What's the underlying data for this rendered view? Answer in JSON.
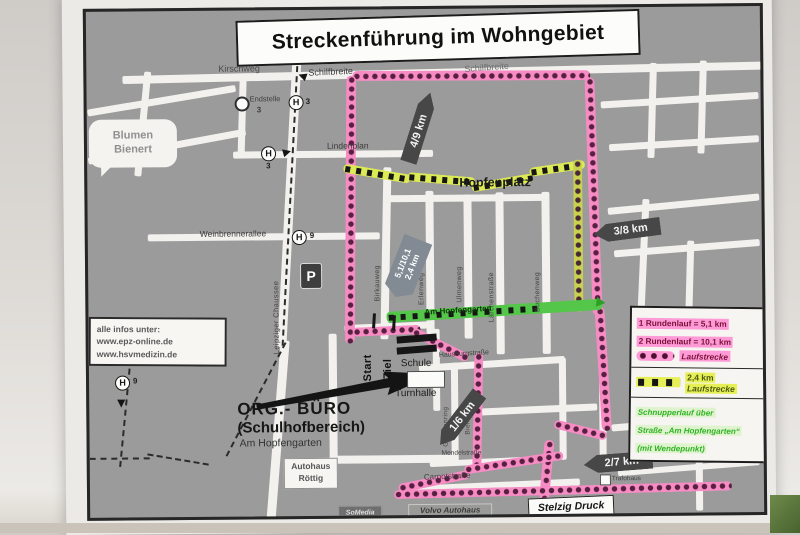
{
  "title": "Streckenführung im Wohngebiet",
  "streets": {
    "kirschweg": "Kirschweg",
    "schilfbreite_left": "Schilfbreite",
    "schilfbreite_right": "Schilfbreite",
    "lindenplan": "Lindenplan",
    "weinbrennerallee": "Weinbrennerallee",
    "leipziger_chaussee": "Leipziger Chaussee",
    "am_hopfengarten": "Am Hopfengarten",
    "carnotstrasse": "Carnotstraße",
    "birkauweg": "Birkauweg",
    "erlenweg": "Erlenweg",
    "ulmenweg": "Ulmenweg",
    "laerchenstrasse": "Lärchenstraße",
    "buchenweg": "Buchenweg",
    "hausburgstrasse": "Hausburgstraße",
    "grolmanring": "Grolmanring",
    "bielenweg": "Bielenweg",
    "mendelstrasse": "Mendelstraße"
  },
  "places": {
    "hopfenplatz": "Hopfenplatz",
    "blumen_line1": "Blumen",
    "blumen_line2": "Bienert",
    "endstelle": "Endstelle",
    "schule": "Schule",
    "turnhalle": "Turnhalle",
    "autohaus_line1": "Autohaus",
    "autohaus_line2": "Röttig",
    "volvo_line1": "Volvo Autohaus",
    "volvo_line2": "Graf Degenhagen",
    "somedia": "SoMedia",
    "stelzig": "Stelzig Druck",
    "trafohaus": "Trafohaus"
  },
  "org_buero": {
    "line1": "ORG.- BÜRO",
    "line2": "(Schulhofbereich)",
    "line3": "Am Hopfengarten"
  },
  "info_box": {
    "line1": "alle infos unter:",
    "line2": "www.epz-online.de",
    "line3": "www.hsvmedizin.de"
  },
  "route_markers": {
    "km_4_9": "4/9 km",
    "km_3_8": "3/8 km",
    "km_1_6": "1/6 km",
    "km_2_7": "2/7 km",
    "start_sign_line1": "5,1/10,1",
    "start_sign_line2": "2,4 km",
    "start": "Start",
    "ziel": "Ziel"
  },
  "transit": {
    "stop_symbol": "H",
    "parking_symbol": "P",
    "endstelle_line": "3",
    "stop_kirschweg": "3",
    "stop_lindenplan": "3",
    "stop_weinbrenner": "9",
    "stop_left": "9"
  },
  "legend": {
    "round1": "1 Rundenlauf = 5,1 km",
    "round2": "2 Rundenlauf = 10,1 km",
    "pink_label": "Laufstrecke",
    "yellow_km": "2,4 km",
    "yellow_label": "Laufstrecke",
    "green_line1": "Schnupperlauf über",
    "green_line2": "Straße „Am Hopfengarten“",
    "green_line3": "(mit Wendepunkt)"
  },
  "colors": {
    "map_gray": "#9b9b9b",
    "street_white": "#f2f1ee",
    "route_pink": "#f78cc4",
    "route_dot_dark": "#571f40",
    "route_yellow": "#dcea55",
    "street_green": "#54c649",
    "legend_pink_highlight": "#fe9bd7",
    "legend_green_text": "#2eb321"
  }
}
